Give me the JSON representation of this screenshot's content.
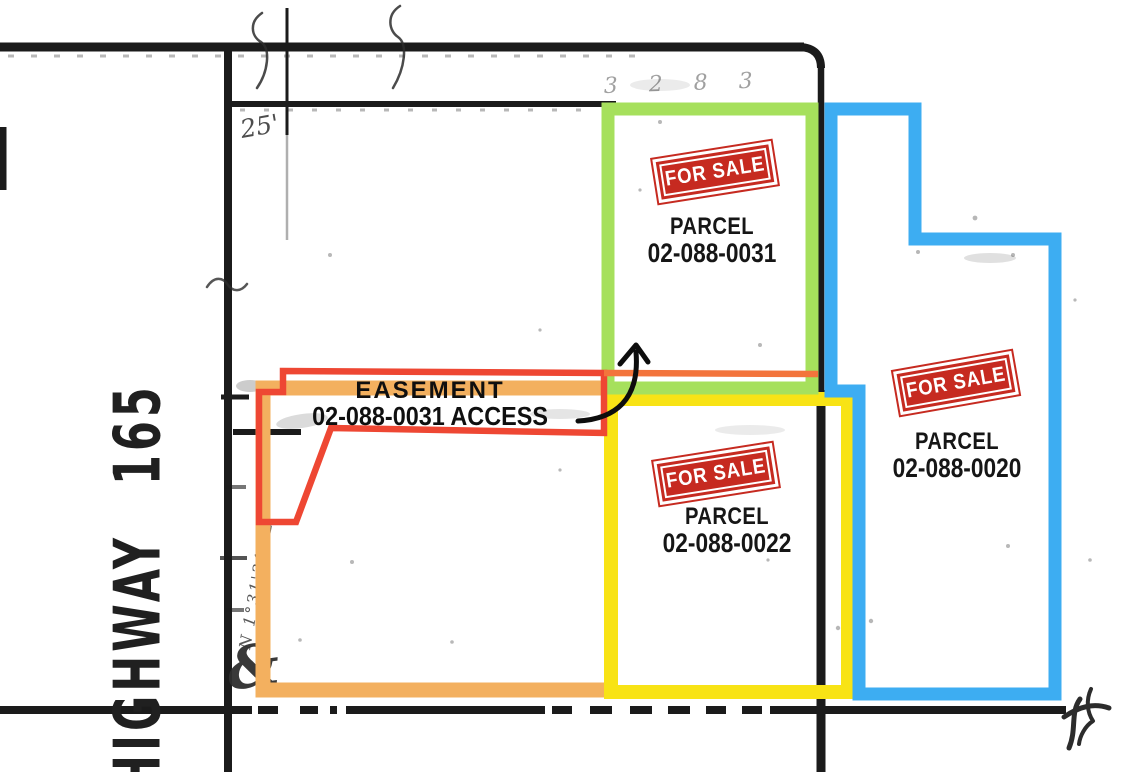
{
  "colors": {
    "green": "#A6E05C",
    "blue": "#3DADF2",
    "yellow": "#F8E315",
    "orange": "#F3B05F",
    "orange_red": "#F3743C",
    "red": "#EE4733",
    "stamp_red": "#C62A20",
    "ink": "#1B1B1B"
  },
  "highway": {
    "label": "HIGHWAY 165"
  },
  "annotations": {
    "dimension_note": "25'",
    "bearing_note": "N 1°31'31\" E",
    "faint_digits": "3 2 8 3",
    "corner_mark": "&"
  },
  "easement": {
    "line1": "EASEMENT",
    "line2": "02-088-0031 ACCESS"
  },
  "parcels": [
    {
      "stamp": "FOR SALE",
      "label": "PARCEL",
      "number": "02-088-0031"
    },
    {
      "stamp": "FOR SALE",
      "label": "PARCEL",
      "number": "02-088-0020"
    },
    {
      "stamp": "FOR SALE",
      "label": "PARCEL",
      "number": "02-088-0022"
    }
  ]
}
